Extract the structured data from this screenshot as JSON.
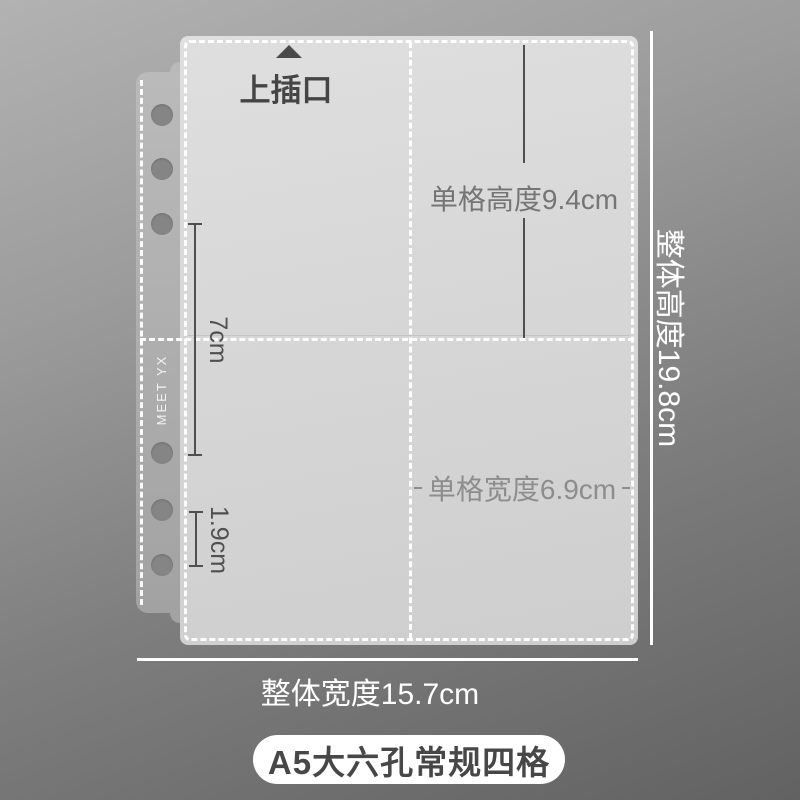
{
  "sleeve": {
    "brand_text": "MEET YX",
    "top_insert_label": "上插口",
    "hole_count": 6
  },
  "measurements": {
    "cell_height": "单格高度9.4cm",
    "cell_width": "单格宽度6.9cm",
    "left_span": "7cm",
    "hole_gap": "1.9cm",
    "overall_height": "整体高度19.8cm",
    "overall_width": "整体宽度15.7cm"
  },
  "footer": {
    "badge_label": "A5大六孔常规四格"
  },
  "colors": {
    "background_top": "#b2b2b2",
    "background_bottom": "#626262",
    "sleeve_fill": "#d7d7d7",
    "spine_fill": "#aeaeae",
    "stitch": "#ffffff",
    "annotation_dark": "#4a4a4a",
    "annotation_gray": "#8d8d8d",
    "white_text": "#ffffff",
    "badge_bg": "#ffffff",
    "badge_text": "#474747"
  }
}
